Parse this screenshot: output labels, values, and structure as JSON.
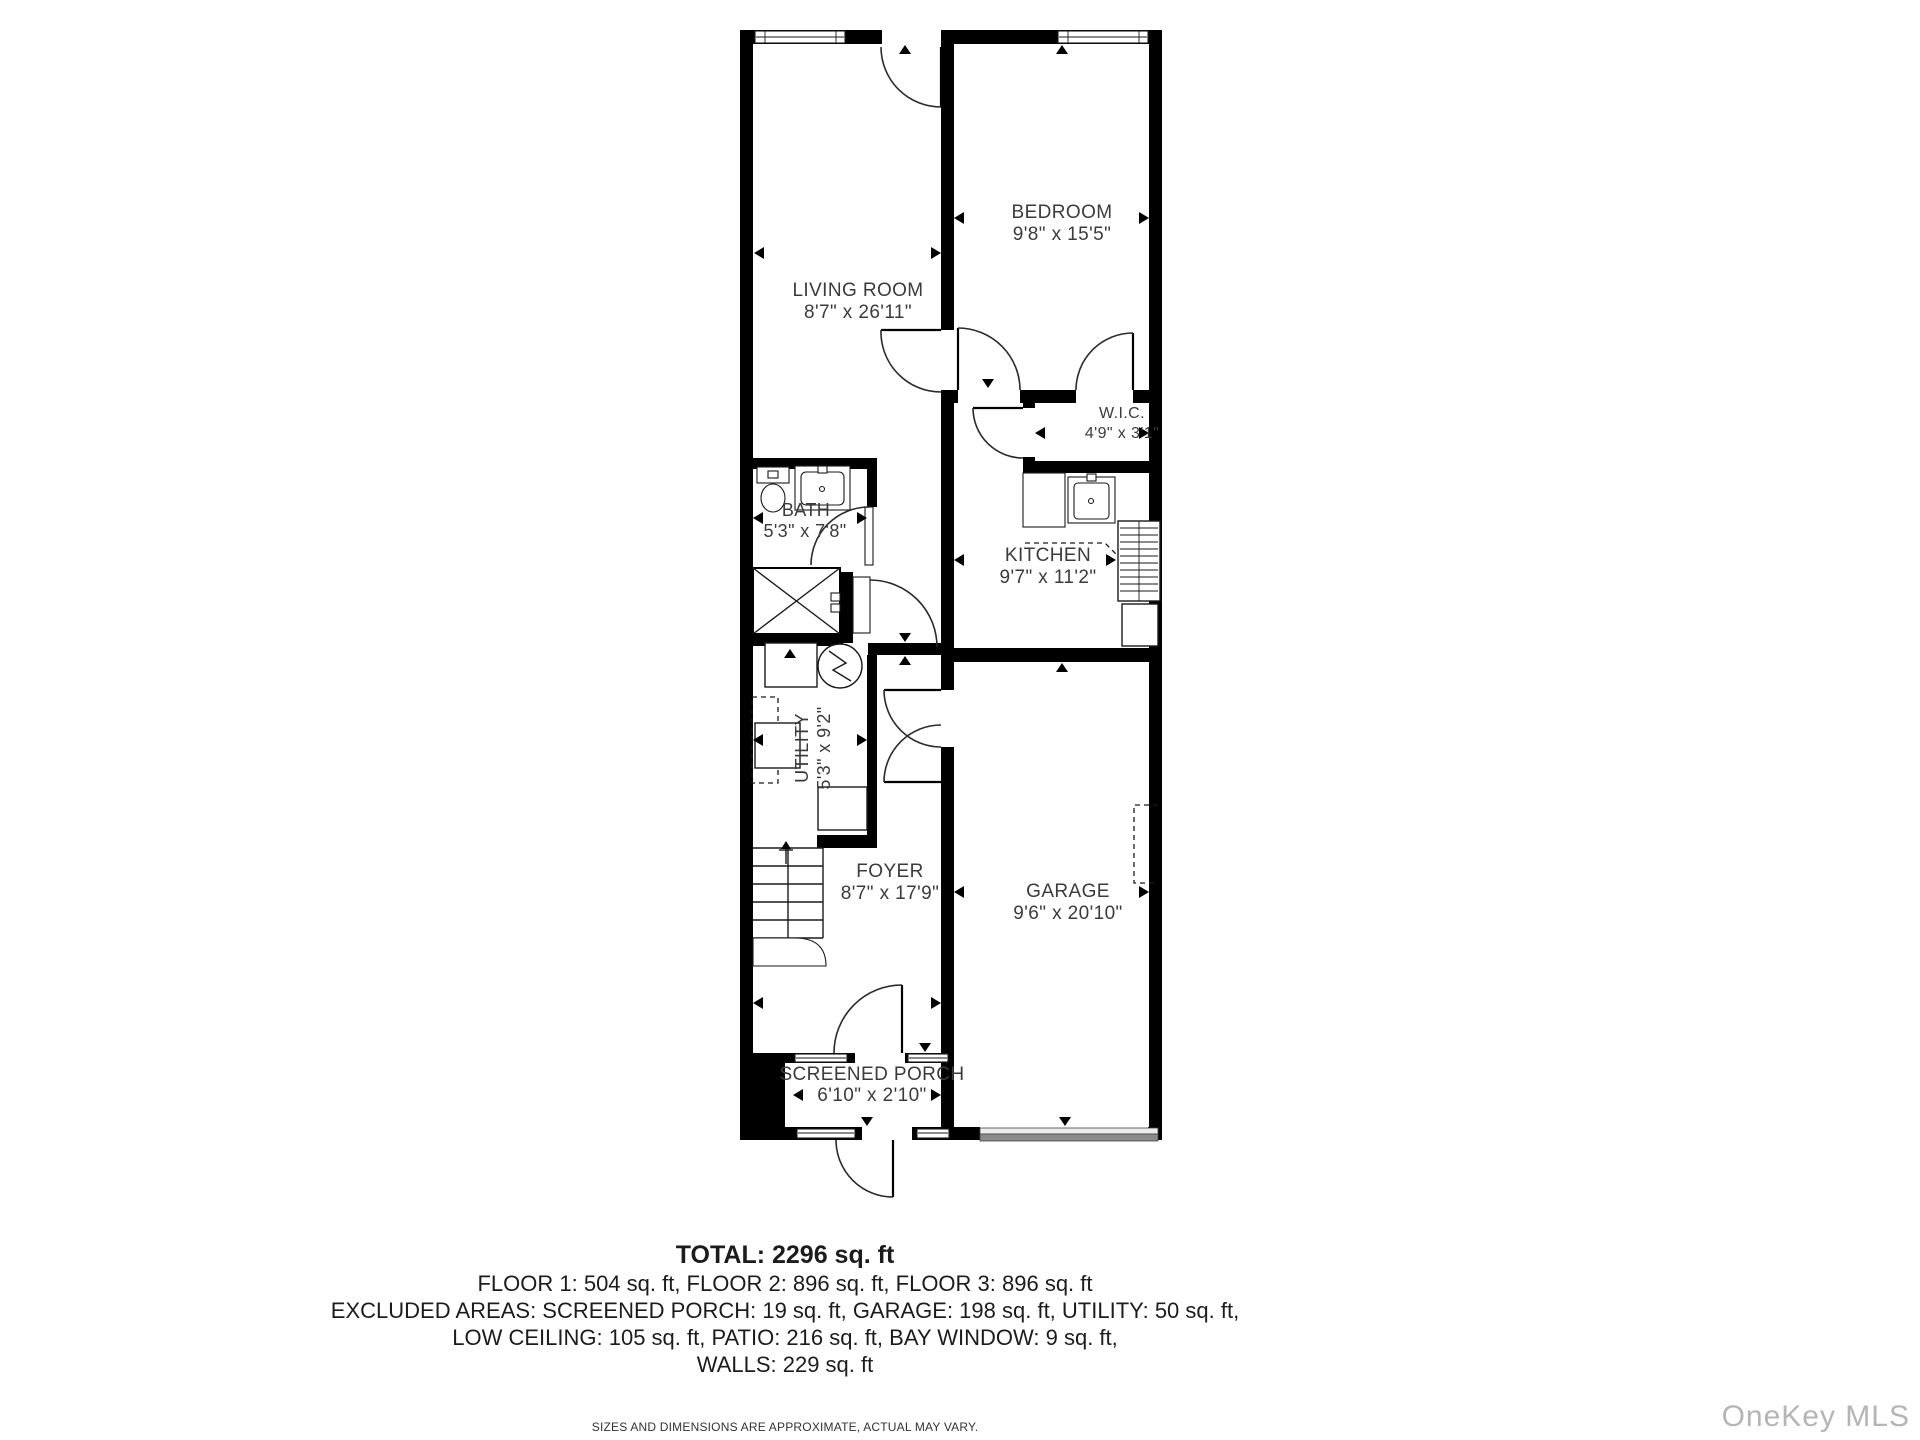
{
  "rooms": [
    {
      "name": "LIVING ROOM",
      "dims": "8'7\" x 26'11\""
    },
    {
      "name": "BEDROOM",
      "dims": "9'8\" x 15'5\""
    },
    {
      "name": "W.I.C.",
      "dims": "4'9\" x 3'1\""
    },
    {
      "name": "BATH",
      "dims": "5'3\" x 7'8\""
    },
    {
      "name": "KITCHEN",
      "dims": "9'7\" x 11'2\""
    },
    {
      "name": "UTILITY",
      "dims": "5'3\" x 9'2\""
    },
    {
      "name": "FOYER",
      "dims": "8'7\" x 17'9\""
    },
    {
      "name": "GARAGE",
      "dims": "9'6\" x 20'10\""
    },
    {
      "name": "SCREENED PORCH",
      "dims": "6'10\" x 2'10\""
    }
  ],
  "summary": {
    "total": "TOTAL: 2296 sq. ft",
    "floors": "FLOOR 1: 504 sq. ft, FLOOR 2: 896 sq. ft, FLOOR 3: 896 sq. ft",
    "excluded1": "EXCLUDED AREAS: SCREENED PORCH: 19 sq. ft, GARAGE: 198 sq. ft, UTILITY: 50 sq. ft,",
    "excluded2": "LOW CEILING: 105 sq. ft, PATIO: 216 sq. ft, BAY WINDOW: 9 sq. ft,",
    "walls": "WALLS: 229 sq. ft",
    "disclaimer": "SIZES AND DIMENSIONS ARE APPROXIMATE, ACTUAL MAY VARY."
  },
  "watermark": "OneKey MLS",
  "colors": {
    "wall": "#000000",
    "label": "#3b3b3b",
    "watermark": "#b5b5b5",
    "garage_door_light": "#ececec",
    "garage_door_dark": "#8a8a8a"
  }
}
